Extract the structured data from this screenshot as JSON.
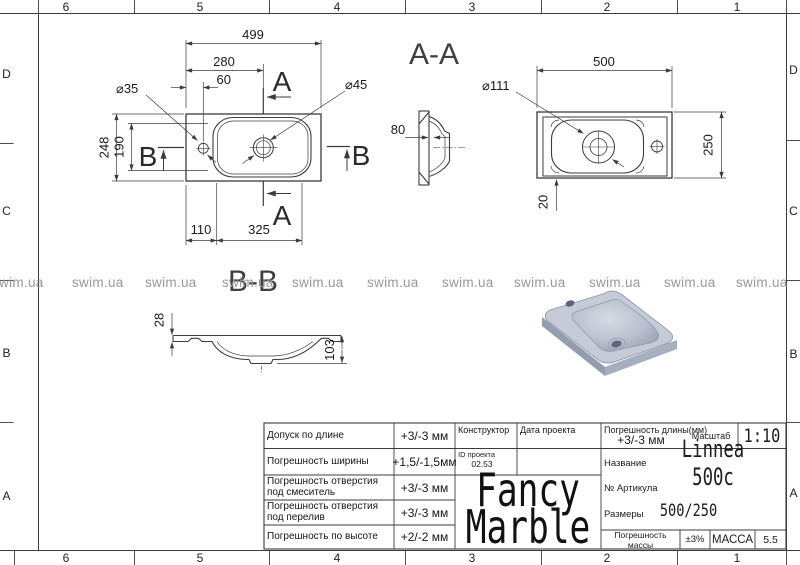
{
  "watermark": {
    "text": "swim.ua"
  },
  "grid": {
    "columns": [
      "6",
      "5",
      "4",
      "3",
      "2",
      "1"
    ],
    "rows": [
      "D",
      "C",
      "B",
      "A"
    ]
  },
  "views": {
    "plan": {
      "dim_width": "499",
      "dim_280": "280",
      "dim_60": "60",
      "dia_faucet": "⌀35",
      "dia_drain": "⌀45",
      "dim_depth": "248",
      "dim_190": "190",
      "dim_110": "110",
      "dim_325": "325",
      "section_a": "A",
      "section_b": "B"
    },
    "section_aa": {
      "label": "A-A",
      "dim_80": "80"
    },
    "bottom": {
      "dim_500": "500",
      "dia_recess": "⌀111",
      "dim_250": "250",
      "dim_20": "20"
    },
    "section_bb": {
      "label": "B-B",
      "dim_28": "28",
      "dim_103": "103"
    }
  },
  "title_block": {
    "rows": [
      {
        "label": "Допуск по длине",
        "value": "+3/-3 мм"
      },
      {
        "label": "Погрешность ширины",
        "value": "+1,5/-1,5мм"
      },
      {
        "label": "Погрешность отверстия\nпод смеситель",
        "value": "+3/-3 мм"
      },
      {
        "label": "Погрешность отверстия\nпод перелив",
        "value": "+3/-3 мм"
      },
      {
        "label": "Погрешность по высоте",
        "value": "+2/-2 мм"
      }
    ],
    "constructor_label": "Конструктор",
    "date_label": "Дата проекта",
    "project_id_label": "ID проекта",
    "project_id_value": "02.53",
    "length_tol_label": "Погрешность длины(мм)",
    "length_tol_value": "+3/-3 мм",
    "scale_label": "Масштаб",
    "scale_value": "1:10",
    "name_label": "Название",
    "name_value": "Linnea 500c",
    "article_label": "№ Артикула",
    "size_label": "Размеры",
    "size_value": "500/250",
    "mass_tol_label": "Погрешность массы",
    "mass_tol_value": "±3%",
    "mass_label": "МАССА",
    "mass_value": "5.5",
    "brand_line1": "Fancy",
    "brand_line2": "Marble"
  }
}
